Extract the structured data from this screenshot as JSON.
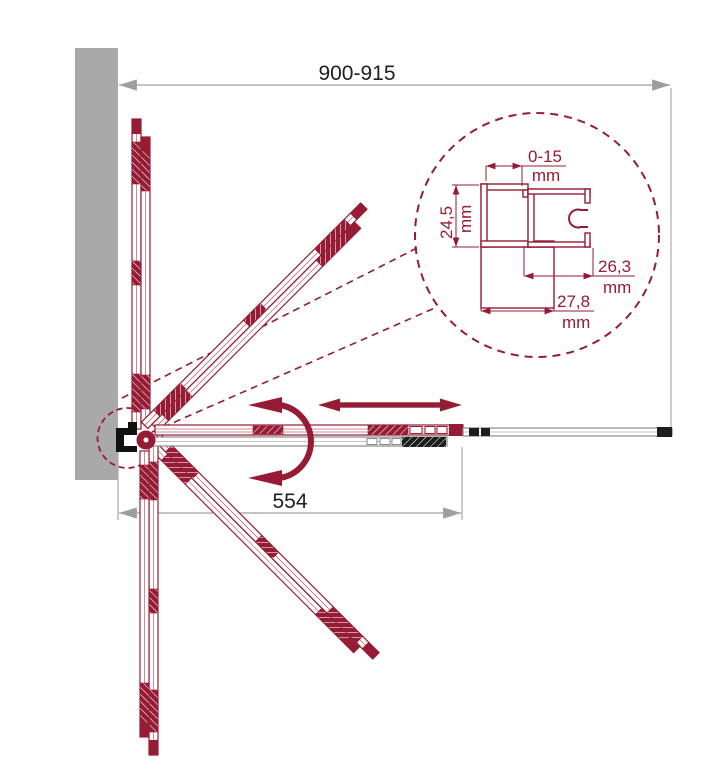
{
  "drawing": {
    "type": "technical-diagram",
    "subject": "bi-fold shower door, top view with profile detail",
    "colors": {
      "accent_red": "#961b34",
      "wall_gray": "#a9a9a9",
      "dim_line_gray": "#b0b0b0",
      "arrow_gray": "#9e9e9e",
      "hardware_black": "#1d1d1d",
      "text_black": "#1f1f1f"
    },
    "icons": {
      "slide_arrow": "double-headed horizontal arrow",
      "rotation_arrow": "curved double-headed rotation arrow"
    },
    "dimensions": {
      "overall_width": "900-915",
      "folding_width": "554",
      "detail": {
        "gap_range": {
          "value": "0-15",
          "unit": "mm"
        },
        "profile_depth": {
          "value": "24,5",
          "unit": "mm"
        },
        "inner_width": {
          "value": "26,3",
          "unit": "mm"
        },
        "outer_width": {
          "value": "27,8",
          "unit": "mm"
        }
      }
    }
  }
}
